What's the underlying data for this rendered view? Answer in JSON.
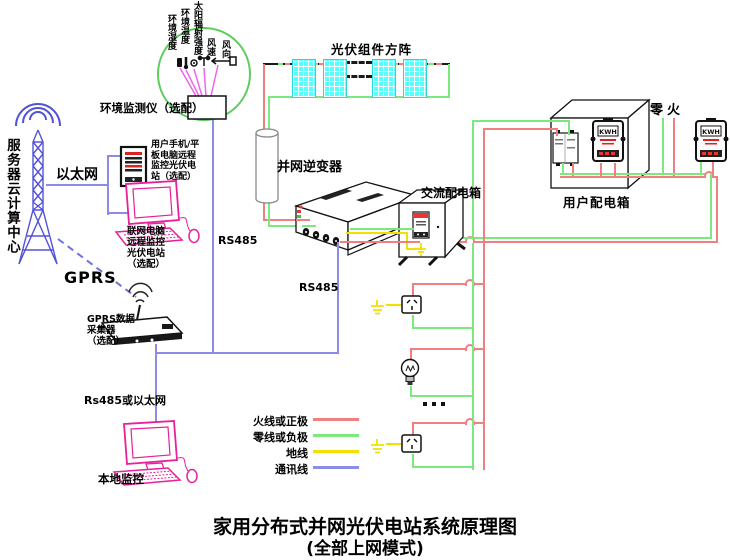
{
  "title": {
    "line1": "家用分布式并网光伏电站系统原理图",
    "line2": "(全部上网模式)"
  },
  "colors": {
    "live_wire": "#f08080",
    "neutral_wire": "#7de87d",
    "ground_wire": "#f2e000",
    "comm_wire": "#8c8ce8",
    "tower_blue": "#5252d8",
    "device_pink": "#e8209a",
    "panel_cyan": "#58ffff",
    "monitor_circle_green": "#5ecc5e",
    "sensor_line_magenta": "#ee66ee"
  },
  "monitoring": {
    "server_center": "服务器云计算中心",
    "ethernet": "以太网",
    "gprs": "GPRS",
    "phone_note": [
      "用户手机/平",
      "板电脑远程",
      "监控光伏电",
      "站（选配）"
    ],
    "pc_note": [
      "联网电脑",
      "远程监控",
      "光伏电站",
      "（选配）"
    ],
    "gprs_collector": [
      "GPRS数据",
      "采集器",
      "（选配）"
    ],
    "rs485_or_ethernet": "Rs485或以太网",
    "local_monitor": "本地监控",
    "rs485": "RS485"
  },
  "environment": {
    "monitor_label": "环境监测仪（选配）",
    "sensors": [
      "环境湿度",
      "环境温度",
      "太阳辐射强度",
      "风速",
      "风向"
    ]
  },
  "system": {
    "pv_array": "光伏组件方阵",
    "inverter": "并网逆变器",
    "ac_box": "交流配电箱",
    "user_box": "用户配电箱",
    "meter_display": "KWH",
    "zero_live": "零火"
  },
  "legend": {
    "items": [
      {
        "label": "火线或正极",
        "type": "live"
      },
      {
        "label": "零线或负极",
        "type": "neutral"
      },
      {
        "label": "地线",
        "type": "ground"
      },
      {
        "label": "通讯线",
        "type": "comm"
      }
    ]
  }
}
